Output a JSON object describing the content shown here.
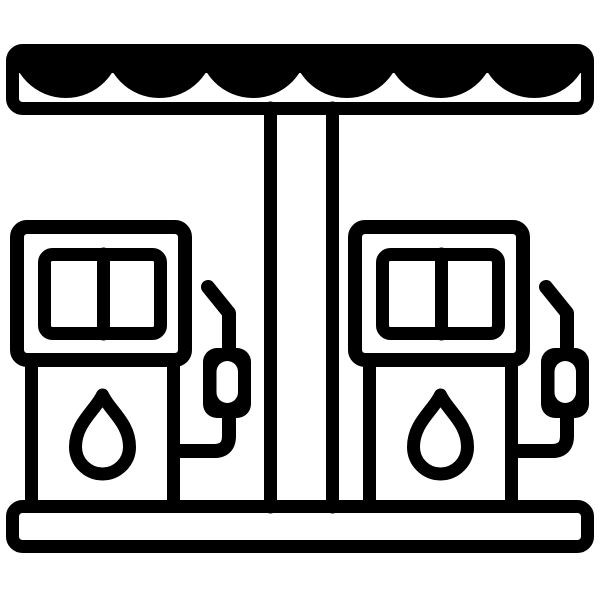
{
  "icon": {
    "name": "gas-station",
    "description": "Gas station icon: scalloped canopy over a central pillar with two fuel pump dispensers, each with a two-pane display, a fuel-drop symbol and a hanging nozzle with hose, standing on a base platform",
    "canopy": {
      "scallop_count": 6
    },
    "pillar": {
      "lines": 2
    },
    "base": {
      "style": "outlined-bar"
    },
    "pumps": [
      {
        "id": "left",
        "display_panes": 2,
        "symbol": "fuel-drop",
        "nozzle": "right-side"
      },
      {
        "id": "right",
        "display_panes": 2,
        "symbol": "fuel-drop",
        "nozzle": "right-side"
      }
    ]
  },
  "colors": {
    "foreground": "#000000",
    "background": "#ffffff"
  }
}
